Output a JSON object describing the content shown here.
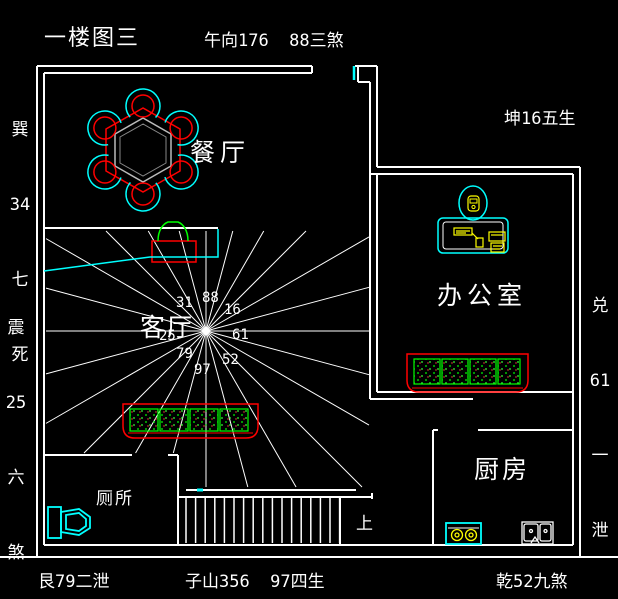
{
  "title": "一楼图三",
  "compass": {
    "top": "午向176  88三煞",
    "top_right": "坤16五生",
    "left_top": [
      "巽",
      "34",
      "七",
      "死"
    ],
    "left_mid": [
      "震",
      "25",
      "六",
      "煞"
    ],
    "right_mid": [
      "兑",
      "61",
      "一",
      "泄"
    ],
    "bottom_left": "艮79二泄",
    "bottom_center": "子山356  97四生",
    "bottom_right": "乾52九煞"
  },
  "rooms": {
    "dining": "餐厅",
    "living": "客厅",
    "office": "办公室",
    "kitchen": "厨房",
    "toilet": "厕所",
    "stairs_up": "上"
  },
  "star": {
    "numbers": [
      "31",
      "88",
      "16",
      "61",
      "52",
      "97",
      "79",
      "25"
    ]
  },
  "colors": {
    "background": "#000000",
    "wall": "#ffffff",
    "fixture_cyan": "#00ffff",
    "furniture_red": "#ff0000",
    "plant_green": "#00ff00",
    "equipment_yellow": "#ffff00"
  }
}
